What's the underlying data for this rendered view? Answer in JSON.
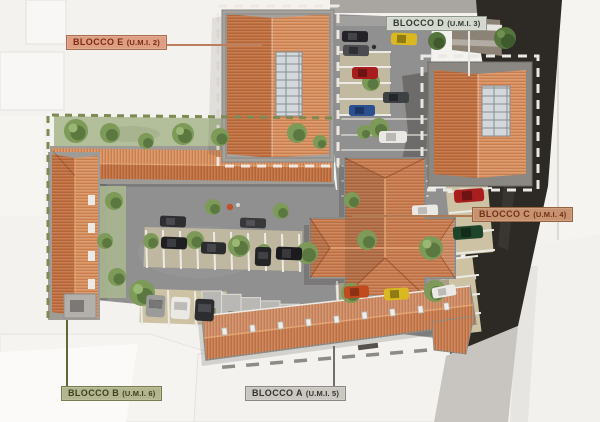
{
  "scene": "Aerial architectural site-plan rendering of a residential block complex with five labeled building units",
  "labels": {
    "blocco_e": {
      "name": "BLOCCO E",
      "umi": "(U.M.I. 2)"
    },
    "blocco_d": {
      "name": "BLOCCO D",
      "umi": "(U.M.I. 3)"
    },
    "blocco_c": {
      "name": "BLOCCO C",
      "umi": "(U.M.I. 4)"
    },
    "blocco_b": {
      "name": "BLOCCO B",
      "umi": "(U.M.I. 6)"
    },
    "blocco_a": {
      "name": "BLOCCO A",
      "umi": "(U.M.I. 5)"
    }
  },
  "palette": {
    "bg": "#f3f2ef",
    "context": "#f8f7f5",
    "context_edge": "#e3e1dc",
    "label_e_bg": "#dd9e82",
    "label_e_border": "#a96f50",
    "label_e_text": "#7c2c12",
    "label_e_line": "#bb7f5e",
    "label_d_bg": "#d4d8cf",
    "label_d_border": "#8e988b",
    "label_d_text": "#2e3b31",
    "label_d_line": "#e7e6e2",
    "label_c_bg": "#c89270",
    "label_c_border": "#97623f",
    "label_c_text": "#6e3316",
    "label_c_line": "#b07a50",
    "label_b_bg": "#b2b58e",
    "label_b_border": "#787d50",
    "label_b_text": "#3c4120",
    "label_b_line": "#606638",
    "label_a_bg": "#cac7c1",
    "label_a_border": "#8c8984",
    "label_a_text": "#343230",
    "label_a_line": "#716f6b",
    "roof_light": "#d8905f",
    "roof_dark": "#c0703f",
    "roof_base": "#c87c4e",
    "ridge": "#e2a574",
    "solar": "#d3d8da",
    "wall_gray": "#9f9c97",
    "asphalt": "#919090",
    "road_dark": "#2d2925",
    "lawn": "#b3bf9a",
    "tree": "#7d9a58",
    "tree_dark": "#5a7840",
    "stall": "#cdc3a4",
    "stall_line": "#eceae4",
    "boundary_green": "#7d8a52",
    "boundary_white": "#efe8e0"
  }
}
